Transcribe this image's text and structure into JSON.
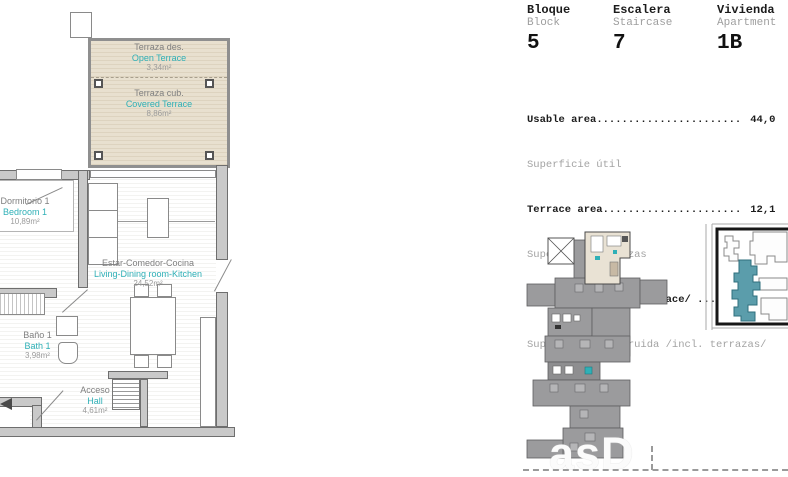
{
  "header": {
    "fields": [
      {
        "label_es": "Bloque",
        "label_en": "Block",
        "value": "5"
      },
      {
        "label_es": "Escalera",
        "label_en": "Staircase",
        "value": "7"
      },
      {
        "label_es": "Vivienda",
        "label_en": "Apartment",
        "value": "1B"
      }
    ]
  },
  "areas": {
    "rows": [
      {
        "label_en": "Usable area",
        "dots": ".......................",
        "value": "44,0",
        "label_es": "Superficie útil"
      },
      {
        "label_en": "Terrace area",
        "dots": "......................",
        "value": "12,1",
        "label_es": "Superficie terrazas"
      },
      {
        "label_en": "Built area /Incl. Terrace/",
        "dots": " ......",
        "value": "65,1",
        "label_es": "Superficie construida /incl. terrazas/"
      }
    ]
  },
  "floorplan": {
    "rooms": [
      {
        "name_es": "Terraza des.",
        "name_en": "Open Terrace",
        "area": "3,34m²"
      },
      {
        "name_es": "Terraza cub.",
        "name_en": "Covered Terrace",
        "area": "8,86m²"
      },
      {
        "name_es": "Dormitorio 1",
        "name_en": "Bedroom 1",
        "area": "10,89m²"
      },
      {
        "name_es": "Estar-Comedor-Cocina",
        "name_en": "Living-Dining room-Kitchen",
        "area": "24,52m²"
      },
      {
        "name_es": "Baño 1",
        "name_en": "Bath 1",
        "area": "3,98m²"
      },
      {
        "name_es": "Acceso",
        "name_en": "Hall",
        "area": "4,61m²"
      }
    ]
  },
  "keyplan": {
    "watermark": "asD"
  },
  "colors": {
    "accent_teal": "#2fb0b7",
    "site_highlight": "#5b9dab",
    "terrace_fill": "#e8e0cf",
    "wall_gray": "#c9c9c9",
    "text_gray": "#9e9e9e"
  }
}
